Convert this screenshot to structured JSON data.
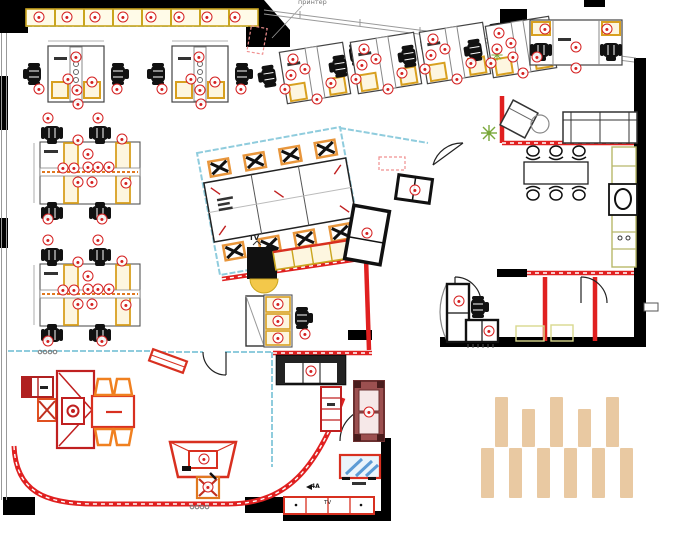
{
  "plan": {
    "title": "Office furniture floor plan",
    "labels": {
      "printer": "принтер",
      "tv_center": "TV",
      "tv_bottom": "TV",
      "section": "4A"
    },
    "colors": {
      "marker_red": "#d42020",
      "wall_red": "#e02020",
      "furniture_yellow": "#d8a020",
      "accent_orange": "#f08020",
      "glass_blue": "#8fccdd",
      "plant_green": "#7aa83a",
      "maroon_sofa": "#9c5050",
      "tan_bar": "#e9c9a2",
      "wall_black": "#000000"
    },
    "markers": {
      "glyph": "●",
      "positions": [
        [
          39,
          17
        ],
        [
          67,
          17
        ],
        [
          95,
          17
        ],
        [
          123,
          17
        ],
        [
          151,
          17
        ],
        [
          179,
          17
        ],
        [
          207,
          17
        ],
        [
          235,
          17
        ],
        [
          76,
          57
        ],
        [
          68,
          79
        ],
        [
          77,
          90
        ],
        [
          92,
          82
        ],
        [
          39,
          89
        ],
        [
          117,
          89
        ],
        [
          78,
          104
        ],
        [
          199,
          57
        ],
        [
          191,
          79
        ],
        [
          200,
          90
        ],
        [
          215,
          82
        ],
        [
          162,
          89
        ],
        [
          241,
          89
        ],
        [
          201,
          104
        ],
        [
          293,
          59
        ],
        [
          291,
          75
        ],
        [
          305,
          69
        ],
        [
          285,
          89
        ],
        [
          317,
          99
        ],
        [
          331,
          83
        ],
        [
          364,
          49
        ],
        [
          362,
          65
        ],
        [
          376,
          59
        ],
        [
          356,
          79
        ],
        [
          388,
          89
        ],
        [
          402,
          73
        ],
        [
          433,
          39
        ],
        [
          431,
          55
        ],
        [
          445,
          49
        ],
        [
          425,
          69
        ],
        [
          457,
          79
        ],
        [
          471,
          63
        ],
        [
          499,
          33
        ],
        [
          497,
          49
        ],
        [
          511,
          43
        ],
        [
          491,
          63
        ],
        [
          523,
          73
        ],
        [
          537,
          57
        ],
        [
          545,
          29
        ],
        [
          607,
          29
        ],
        [
          576,
          47
        ],
        [
          576,
          68
        ],
        [
          513,
          57
        ],
        [
          48,
          118
        ],
        [
          98,
          118
        ],
        [
          78,
          140
        ],
        [
          122,
          139
        ],
        [
          88,
          154
        ],
        [
          63,
          168
        ],
        [
          74,
          168
        ],
        [
          88,
          167
        ],
        [
          98,
          167
        ],
        [
          109,
          167
        ],
        [
          78,
          182
        ],
        [
          92,
          182
        ],
        [
          126,
          183
        ],
        [
          48,
          219
        ],
        [
          102,
          219
        ],
        [
          48,
          240
        ],
        [
          98,
          240
        ],
        [
          78,
          262
        ],
        [
          122,
          261
        ],
        [
          88,
          276
        ],
        [
          63,
          290
        ],
        [
          74,
          290
        ],
        [
          88,
          289
        ],
        [
          98,
          289
        ],
        [
          109,
          289
        ],
        [
          78,
          304
        ],
        [
          92,
          304
        ],
        [
          126,
          305
        ],
        [
          48,
          341
        ],
        [
          102,
          341
        ],
        [
          278,
          304
        ],
        [
          278,
          321
        ],
        [
          278,
          338
        ],
        [
          305,
          334
        ],
        [
          415,
          190
        ],
        [
          367,
          233
        ],
        [
          459,
          301
        ],
        [
          489,
          331
        ],
        [
          311,
          371
        ],
        [
          369,
          412
        ],
        [
          204,
          459
        ],
        [
          208,
          487
        ]
      ]
    },
    "tan_bars": {
      "color": "#e9c9a2",
      "top_row": [
        {
          "x": 495,
          "y": 397,
          "w": 13,
          "h": 50
        },
        {
          "x": 522,
          "y": 409,
          "w": 13,
          "h": 38
        },
        {
          "x": 550,
          "y": 397,
          "w": 13,
          "h": 50
        },
        {
          "x": 578,
          "y": 409,
          "w": 13,
          "h": 38
        },
        {
          "x": 606,
          "y": 397,
          "w": 13,
          "h": 50
        }
      ],
      "bottom_row": [
        {
          "x": 481,
          "y": 448,
          "w": 13,
          "h": 50
        },
        {
          "x": 509,
          "y": 448,
          "w": 13,
          "h": 50
        },
        {
          "x": 537,
          "y": 448,
          "w": 13,
          "h": 50
        },
        {
          "x": 564,
          "y": 448,
          "w": 13,
          "h": 50
        },
        {
          "x": 592,
          "y": 448,
          "w": 13,
          "h": 50
        },
        {
          "x": 620,
          "y": 448,
          "w": 13,
          "h": 50
        }
      ]
    }
  }
}
